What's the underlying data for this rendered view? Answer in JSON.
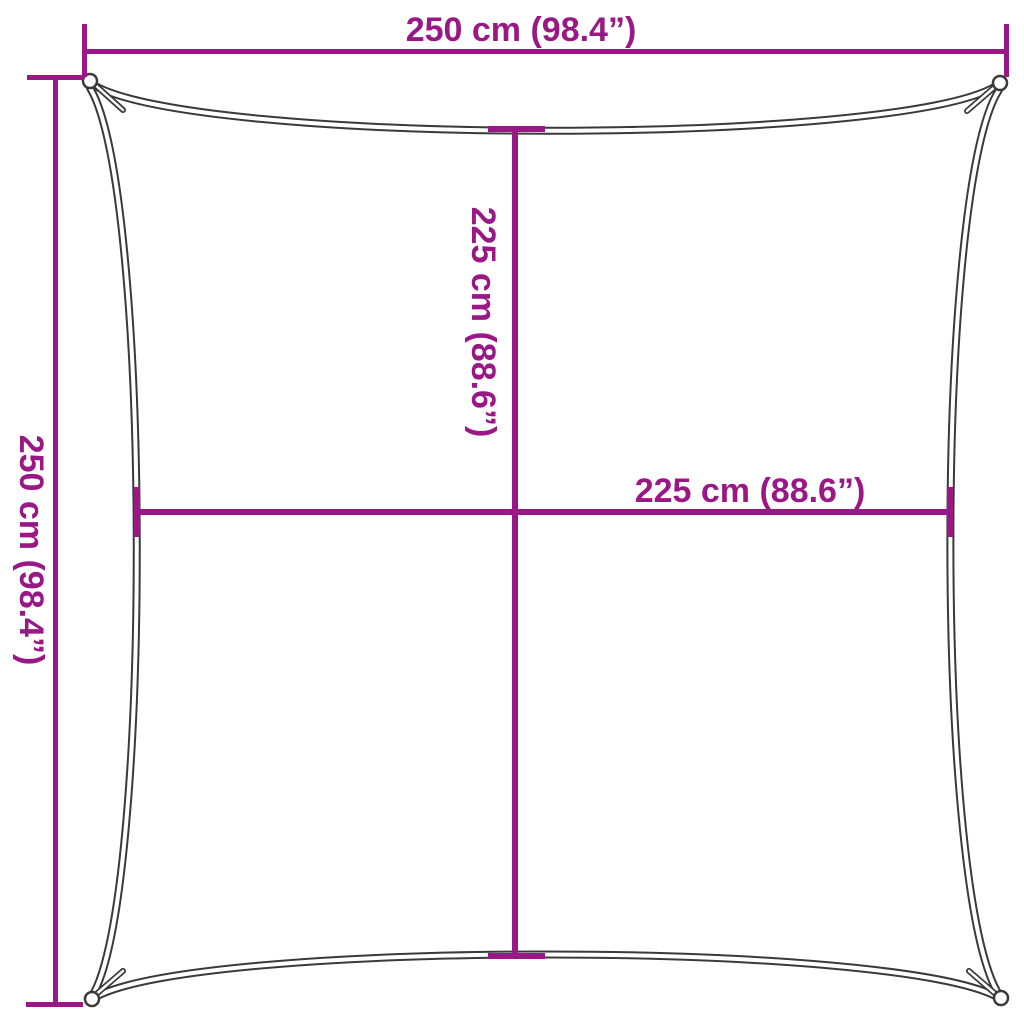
{
  "diagram": {
    "colors": {
      "dimension": "#9a1786",
      "sail_outline": "#3a3a3a",
      "background": "#ffffff"
    },
    "dimensions": {
      "top": {
        "label": "250 cm (98.4”)"
      },
      "left": {
        "label": "250 cm (98.4”)"
      },
      "inner_vertical": {
        "label": "225 cm (88.6”)"
      },
      "inner_horizontal": {
        "label": "225 cm (88.6”)"
      }
    }
  }
}
